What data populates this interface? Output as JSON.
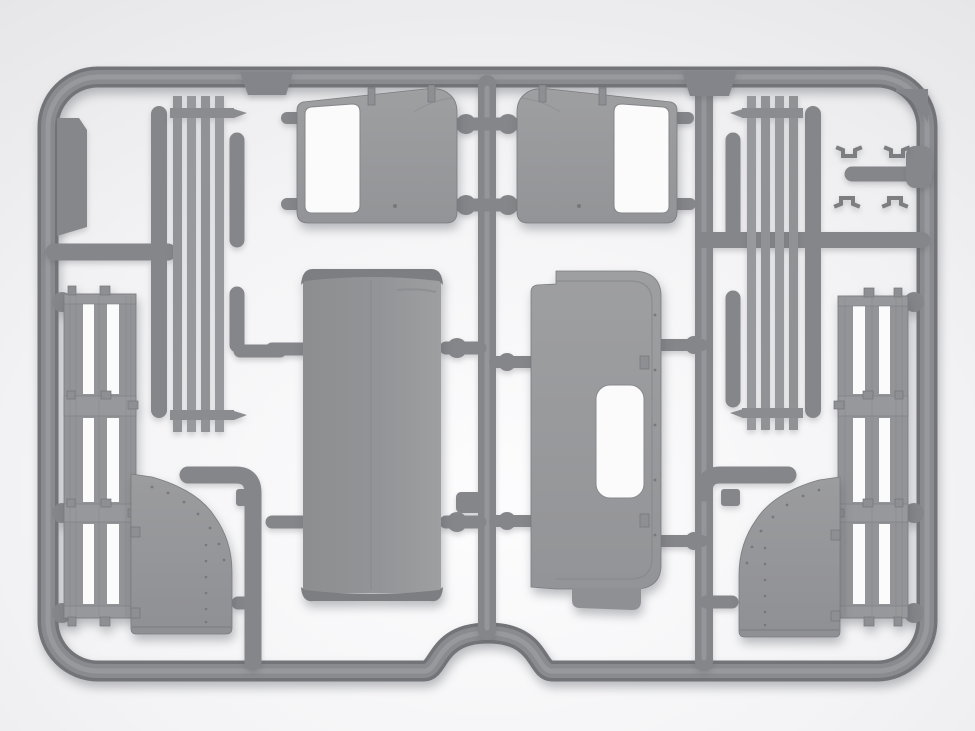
{
  "scene": {
    "domain": "natural-image",
    "subject": "Gray injection-molded plastic model-kit sprue (runner frame) holding truck-cab parts",
    "setting": "soft light studio backdrop with gentle vignette, diffuse drop shadow under the sprue"
  },
  "colors": {
    "bg_center": "#fdfdfe",
    "bg_mid": "#f3f3f5",
    "bg_edge": "#e6e6e8",
    "pipe_dark": "#737478",
    "pipe_mid": "#8a8b8f",
    "pipe_light": "#9b9c9f",
    "part_light": "#9e9fa1",
    "part_mid": "#939497",
    "part_dark": "#7d7e82",
    "cutout": "#fbfbfc",
    "line_dark": "#7a7b7f"
  },
  "sprue": {
    "frame": "rounded rectangular runner with a semicircular arch notch at bottom center",
    "parts": [
      {
        "id": "cab-door-left",
        "desc": "left cab door with window opening and two hinge tabs"
      },
      {
        "id": "cab-door-right",
        "desc": "right cab door (mirrored) with window opening and two hinge tabs"
      },
      {
        "id": "roof-panel",
        "desc": "rectangular cab roof panel with rolled front/rear edges and center seam"
      },
      {
        "id": "rear-panel",
        "desc": "cab rear wall with rounded corners, stepped edges and rectangular window opening"
      },
      {
        "id": "slat-rails-left",
        "desc": "bundle of four flat slats plus round rods with crossbars"
      },
      {
        "id": "slat-rails-right",
        "desc": "mirrored bundle of four flat slats plus round rods"
      },
      {
        "id": "side-board-left",
        "desc": "long slatted drop-side board with hinge tabs and brackets"
      },
      {
        "id": "side-board-right",
        "desc": "mirrored long slatted drop-side board"
      },
      {
        "id": "cab-side-panel-left",
        "desc": "curved cab side / fender panel with rivet rows"
      },
      {
        "id": "cab-side-panel-right",
        "desc": "mirrored curved cab side / fender panel with rivet rows"
      },
      {
        "id": "small-brackets",
        "desc": "four small U-shaped brackets near the top-right corner"
      },
      {
        "id": "flat-strips",
        "desc": "thin flat strips molded against the top rail"
      },
      {
        "id": "corner-blocks",
        "desc": "small filler blocks in the upper corners and on the right rail"
      }
    ]
  },
  "counts": {
    "doors": 2,
    "side_boards": 2,
    "fender_panels": 2,
    "small_brackets": 4,
    "slat_bundles": 2
  }
}
